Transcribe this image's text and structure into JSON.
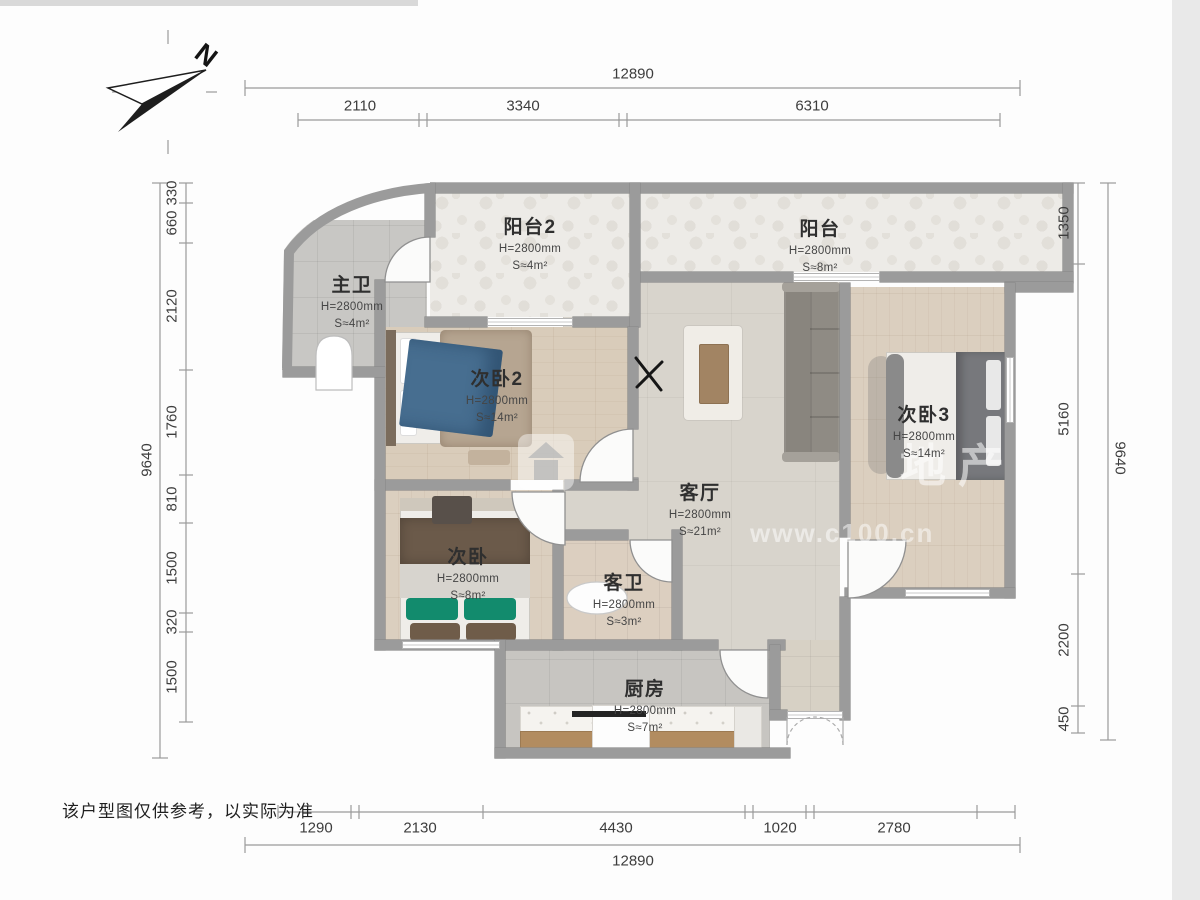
{
  "page": {
    "disclaimer": "该户型图仅供参考，以实际为准"
  },
  "compass": {
    "label": "N"
  },
  "watermark": {
    "icon": "house-icon",
    "brand": "地产",
    "url": "www.c100.cn"
  },
  "dims": {
    "top_total": "12890",
    "top": [
      "2110",
      "3340",
      "6310"
    ],
    "bottom_total": "12890",
    "bottom": [
      "1290",
      "2130",
      "4430",
      "1020",
      "2780"
    ],
    "left_total": "9640",
    "left": [
      "330",
      "660",
      "2120",
      "1760",
      "810",
      "1500",
      "320",
      "1500"
    ],
    "right_total": "9640",
    "right": [
      "1350",
      "5160",
      "2200",
      "450"
    ]
  },
  "rooms": [
    {
      "id": "balcony2",
      "name": "阳台2",
      "h": "H=2800mm",
      "s": "S≈4m²"
    },
    {
      "id": "balcony",
      "name": "阳台",
      "h": "H=2800mm",
      "s": "S≈8m²"
    },
    {
      "id": "master-bath",
      "name": "主卫",
      "h": "H=2800mm",
      "s": "S≈4m²"
    },
    {
      "id": "bedroom2",
      "name": "次卧2",
      "h": "H=2800mm",
      "s": "S≈14m²"
    },
    {
      "id": "bedroom3",
      "name": "次卧3",
      "h": "H=2800mm",
      "s": "S≈14m²"
    },
    {
      "id": "living",
      "name": "客厅",
      "h": "H=2800mm",
      "s": "S≈21m²"
    },
    {
      "id": "bedroom",
      "name": "次卧",
      "h": "H=2800mm",
      "s": "S≈8m²"
    },
    {
      "id": "guest-bath",
      "name": "客卫",
      "h": "H=2800mm",
      "s": "S≈3m²"
    },
    {
      "id": "kitchen",
      "name": "厨房",
      "h": "H=2800mm",
      "s": "S≈7m²"
    }
  ]
}
